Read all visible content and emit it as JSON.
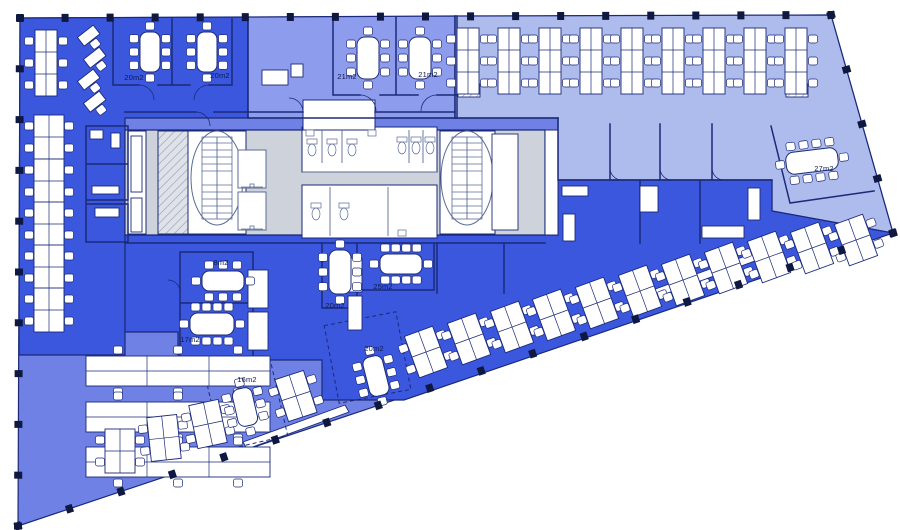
{
  "colors": {
    "dark": "#3b57de",
    "medium": "#6f81e5",
    "medLav": "#8d9ced",
    "light": "#aebced",
    "core": "#ced3db",
    "wall": "#1b2a78",
    "fixture": "#5b6b96",
    "furniture": "#ffffff",
    "column": "#0e1840"
  },
  "outline": [
    [
      20,
      18
    ],
    [
      831,
      15
    ],
    [
      893,
      233
    ],
    [
      18,
      526
    ]
  ],
  "zones": [
    {
      "name": "open-office-bottom-left",
      "color": "medium",
      "pts": [
        [
          20,
          18
        ],
        [
          831,
          15
        ],
        [
          893,
          233
        ],
        [
          18,
          526
        ]
      ]
    },
    {
      "name": "open-office-top-left",
      "color": "dark",
      "pts": [
        [
          20,
          18
        ],
        [
          248,
          17
        ],
        [
          248,
          118
        ],
        [
          125,
          118
        ],
        [
          125,
          355
        ],
        [
          19,
          355
        ]
      ]
    },
    {
      "name": "reception-band",
      "color": "medLav",
      "pts": [
        [
          248,
          17
        ],
        [
          455,
          16
        ],
        [
          455,
          118
        ],
        [
          248,
          118
        ]
      ]
    },
    {
      "name": "open-office-top-right",
      "color": "light",
      "pts": [
        [
          455,
          16
        ],
        [
          831,
          15
        ],
        [
          893,
          233
        ],
        [
          772,
          211
        ],
        [
          772,
          180
        ],
        [
          558,
          180
        ],
        [
          558,
          118
        ],
        [
          455,
          118
        ]
      ]
    },
    {
      "name": "open-office-central",
      "color": "dark",
      "pts": [
        [
          125,
          235
        ],
        [
          558,
          235
        ],
        [
          558,
          180
        ],
        [
          772,
          180
        ],
        [
          772,
          211
        ],
        [
          893,
          233
        ],
        [
          404,
          400
        ],
        [
          322,
          400
        ],
        [
          322,
          360
        ],
        [
          178,
          360
        ],
        [
          178,
          332
        ],
        [
          125,
          332
        ]
      ]
    },
    {
      "name": "core-block",
      "color": "core",
      "pts": [
        [
          125,
          130
        ],
        [
          545,
          130
        ],
        [
          545,
          235
        ],
        [
          125,
          235
        ]
      ]
    }
  ],
  "white_rooms": [
    {
      "x": 188,
      "y": 131,
      "w": 58,
      "h": 103
    },
    {
      "x": 440,
      "y": 131,
      "w": 55,
      "h": 103
    },
    {
      "x": 302,
      "y": 127,
      "w": 135,
      "h": 45
    },
    {
      "x": 302,
      "y": 185,
      "w": 135,
      "h": 53
    },
    {
      "x": 545,
      "y": 130,
      "w": 13,
      "h": 105
    },
    {
      "x": 303,
      "y": 100,
      "w": 72,
      "h": 30
    },
    {
      "x": 128,
      "y": 131,
      "w": 18,
      "h": 103
    },
    {
      "x": 158,
      "y": 131,
      "w": 30,
      "h": 103,
      "hatch": true
    }
  ],
  "terraces": [
    [
      [
        650,
        291
      ],
      [
        770,
        247
      ],
      [
        774,
        254
      ],
      [
        654,
        298
      ]
    ],
    [
      [
        243,
        442
      ],
      [
        345,
        405
      ],
      [
        349,
        412
      ],
      [
        247,
        449
      ]
    ]
  ],
  "stairs": [
    [
      217,
      178
    ],
    [
      467,
      178
    ]
  ],
  "elevators": [
    [
      238,
      150,
      28,
      38
    ],
    [
      238,
      192,
      28,
      38
    ]
  ],
  "wcs": [
    [
      312,
      150
    ],
    [
      332,
      150
    ],
    [
      352,
      150
    ],
    [
      402,
      148
    ],
    [
      416,
      148
    ],
    [
      430,
      148
    ],
    [
      316,
      214
    ],
    [
      344,
      214
    ]
  ],
  "sinks": [
    [
      306,
      130,
      8,
      6
    ],
    [
      368,
      130,
      8,
      6
    ],
    [
      398,
      230,
      8,
      6
    ]
  ],
  "walls": [
    "M113,19 V85 H139 M158,85 H190 M209,85 H232 V19 M172,19 V85",
    "M333,17 V95 H360 M380,95 H418 M437,95 H457 M457,16 V118 M396,17 V95",
    "M248,17 V118 M248,118 H558",
    "M125,112 H196 M214,112 H303 M375,112 H455",
    "M455,16 V118",
    "M558,118 V180 H772 M610,124 V180 M660,124 V180 M712,124 V180 M640,181 V243 M700,181 V243",
    "M180,252 H253 V303 M180,252 V358 M180,303 H253 M253,305 V358 M180,358 H253",
    "M322,243 V308 H357 M357,243 V308 M360,290 H434 M434,243 V290",
    "M437,243 V293 M504,243 V293",
    "M771,126 L790,203 L874,191",
    "M86,126 H128 V200 H86 M86,126 V242 M86,164 H128 M86,204 H128 M128,204 V242 M86,242 H128",
    "M125,243 H545"
  ],
  "toilet_partitions": "M322,130 V163 M342,130 V163 M409,130 V163 M423,130 V163 M330,187 V236 M388,187 V236 M302,172 H437",
  "door_arcs": [
    "M139,85 a15,15 0 0 1 15,15",
    "M209,85 a15,15 0 0 0 -15,15",
    "M360,95 a16,16 0 0 1 16,16",
    "M437,95 a16,16 0 0 0 -16,16",
    "M196,112 a14,14 0 0 1 14,14",
    "M303,112 a14,14 0 0 0 -14,-14",
    "M610,168 a12,12 0 0 0 12,12",
    "M660,168 a12,12 0 0 0 12,12",
    "M712,168 a12,12 0 0 0 12,12",
    "M180,292 a12,12 0 0 0 -12,-12"
  ],
  "dashed_rooms": [
    {
      "x": 213,
      "y": 368,
      "w": 67,
      "h": 76,
      "r": -13
    },
    {
      "x": 331,
      "y": 318,
      "w": 73,
      "h": 79,
      "r": -11
    }
  ],
  "cabinets": [
    {
      "x": 248,
      "y": 270,
      "w": 20,
      "h": 38
    },
    {
      "x": 248,
      "y": 312,
      "w": 20,
      "h": 38
    },
    {
      "x": 348,
      "y": 258,
      "w": 14,
      "h": 34
    },
    {
      "x": 348,
      "y": 296,
      "w": 14,
      "h": 34
    },
    {
      "x": 131,
      "y": 136,
      "w": 11,
      "h": 56
    },
    {
      "x": 131,
      "y": 198,
      "w": 11,
      "h": 34
    },
    {
      "x": 90,
      "y": 130,
      "w": 13,
      "h": 9
    },
    {
      "x": 111,
      "y": 133,
      "w": 9,
      "h": 15
    },
    {
      "x": 92,
      "y": 186,
      "w": 27,
      "h": 8
    },
    {
      "x": 95,
      "y": 208,
      "w": 24,
      "h": 9
    },
    {
      "x": 562,
      "y": 186,
      "w": 26,
      "h": 10
    },
    {
      "x": 563,
      "y": 214,
      "w": 12,
      "h": 27
    },
    {
      "x": 640,
      "y": 186,
      "w": 18,
      "h": 26
    },
    {
      "x": 702,
      "y": 226,
      "w": 42,
      "h": 12
    },
    {
      "x": 748,
      "y": 188,
      "w": 12,
      "h": 32
    },
    {
      "x": 492,
      "y": 134,
      "w": 26,
      "h": 96
    },
    {
      "x": 262,
      "y": 70,
      "w": 26,
      "h": 15
    },
    {
      "x": 291,
      "y": 64,
      "w": 12,
      "h": 13
    },
    {
      "x": 458,
      "y": 84,
      "w": 22,
      "h": 13,
      "hatch": true
    },
    {
      "x": 786,
      "y": 84,
      "w": 22,
      "h": 13,
      "hatch": true
    }
  ],
  "desk_pods": [
    {
      "t": "pod23v",
      "x": 46,
      "y": 63,
      "r": 0
    },
    {
      "t": "single",
      "x": 89,
      "y": 36,
      "r": -38
    },
    {
      "t": "single",
      "x": 95,
      "y": 58,
      "r": -38
    },
    {
      "t": "single",
      "x": 89,
      "y": 80,
      "r": -38
    },
    {
      "t": "single",
      "x": 95,
      "y": 102,
      "r": -38
    },
    {
      "t": "pod22",
      "x": 49,
      "y": 137,
      "r": 0
    },
    {
      "t": "pod22",
      "x": 49,
      "y": 181,
      "r": 0
    },
    {
      "t": "pod22",
      "x": 49,
      "y": 224,
      "r": 0
    },
    {
      "t": "pod22",
      "x": 49,
      "y": 267,
      "r": 0
    },
    {
      "t": "pod22",
      "x": 49,
      "y": 310,
      "r": 0
    },
    {
      "t": "bench3h",
      "x": 178,
      "y": 371,
      "r": 0
    },
    {
      "t": "bench3h",
      "x": 178,
      "y": 417,
      "r": 0
    },
    {
      "t": "bench3h",
      "x": 178,
      "y": 462,
      "r": 0
    },
    {
      "t": "pod23v",
      "x": 468,
      "y": 61,
      "r": 0
    },
    {
      "t": "pod23v",
      "x": 509,
      "y": 61,
      "r": 0
    },
    {
      "t": "pod23v",
      "x": 550,
      "y": 61,
      "r": 0
    },
    {
      "t": "pod23v",
      "x": 591,
      "y": 61,
      "r": 0
    },
    {
      "t": "pod23v",
      "x": 632,
      "y": 61,
      "r": 0
    },
    {
      "t": "pod23v",
      "x": 673,
      "y": 61,
      "r": 0
    },
    {
      "t": "pod23v",
      "x": 714,
      "y": 61,
      "r": 0
    },
    {
      "t": "pod23v",
      "x": 755,
      "y": 61,
      "r": 0
    },
    {
      "t": "pod23v",
      "x": 796,
      "y": 61,
      "r": 0
    },
    {
      "t": "pod22",
      "x": 120,
      "y": 451,
      "r": 0
    },
    {
      "t": "pod22",
      "x": 164,
      "y": 438,
      "r": -6
    },
    {
      "t": "pod22",
      "x": 208,
      "y": 424,
      "r": -12
    },
    {
      "t": "pod22",
      "x": 296,
      "y": 396,
      "r": -18
    },
    {
      "t": "pod22",
      "x": 426,
      "y": 352,
      "r": -20
    },
    {
      "t": "pod22",
      "x": 469,
      "y": 339,
      "r": -20
    },
    {
      "t": "pod22",
      "x": 512,
      "y": 327,
      "r": -20
    },
    {
      "t": "pod22",
      "x": 554,
      "y": 315,
      "r": -20
    },
    {
      "t": "pod22",
      "x": 597,
      "y": 303,
      "r": -20
    },
    {
      "t": "pod22",
      "x": 640,
      "y": 291,
      "r": -20
    },
    {
      "t": "pod22",
      "x": 683,
      "y": 280,
      "r": -20
    },
    {
      "t": "pod22",
      "x": 726,
      "y": 268,
      "r": -20
    },
    {
      "t": "pod22",
      "x": 769,
      "y": 257,
      "r": -20
    },
    {
      "t": "pod22",
      "x": 812,
      "y": 248,
      "r": -20
    },
    {
      "t": "pod22",
      "x": 856,
      "y": 240,
      "r": -20
    }
  ],
  "meeting_tables": [
    {
      "x": 150,
      "y": 52,
      "w": 20,
      "h": 40,
      "r": 0,
      "seats": 8
    },
    {
      "x": 207,
      "y": 52,
      "w": 20,
      "h": 40,
      "r": 0,
      "seats": 8
    },
    {
      "x": 368,
      "y": 58,
      "w": 22,
      "h": 42,
      "r": 0,
      "seats": 8
    },
    {
      "x": 420,
      "y": 58,
      "w": 22,
      "h": 42,
      "r": 0,
      "seats": 8
    },
    {
      "x": 223,
      "y": 281,
      "w": 42,
      "h": 20,
      "r": 0,
      "seats": 8
    },
    {
      "x": 212,
      "y": 324,
      "w": 44,
      "h": 22,
      "r": 0,
      "seats": 10
    },
    {
      "x": 340,
      "y": 272,
      "w": 22,
      "h": 44,
      "r": 0,
      "seats": 8
    },
    {
      "x": 401,
      "y": 264,
      "w": 42,
      "h": 20,
      "r": 0,
      "seats": 10
    },
    {
      "x": 376,
      "y": 376,
      "w": 20,
      "h": 40,
      "r": -14,
      "seats": 8
    },
    {
      "x": 245,
      "y": 407,
      "w": 20,
      "h": 38,
      "r": -13,
      "seats": 8
    },
    {
      "x": 812,
      "y": 161,
      "w": 52,
      "h": 22,
      "r": -7,
      "seats": 10
    }
  ],
  "room_labels": [
    {
      "text": "20m2",
      "x": 134,
      "y": 80
    },
    {
      "text": "20m2",
      "x": 220,
      "y": 78
    },
    {
      "text": "21m2",
      "x": 347,
      "y": 79
    },
    {
      "text": "21m2",
      "x": 428,
      "y": 77
    },
    {
      "text": "27m2",
      "x": 824,
      "y": 171
    },
    {
      "text": "8m2",
      "x": 221,
      "y": 265
    },
    {
      "text": "17m2",
      "x": 190,
      "y": 342
    },
    {
      "text": "20m2",
      "x": 335,
      "y": 308
    },
    {
      "text": "25m2",
      "x": 383,
      "y": 289
    },
    {
      "text": "20m2",
      "x": 374,
      "y": 351
    },
    {
      "text": "16m2",
      "x": 247,
      "y": 382
    }
  ],
  "perimeter_columns": [
    {
      "a": 0,
      "b": 1,
      "n": 19
    },
    {
      "a": 1,
      "b": 2,
      "n": 5
    },
    {
      "a": 2,
      "b": 3,
      "n": 18
    },
    {
      "a": 3,
      "b": 0,
      "n": 11
    }
  ]
}
